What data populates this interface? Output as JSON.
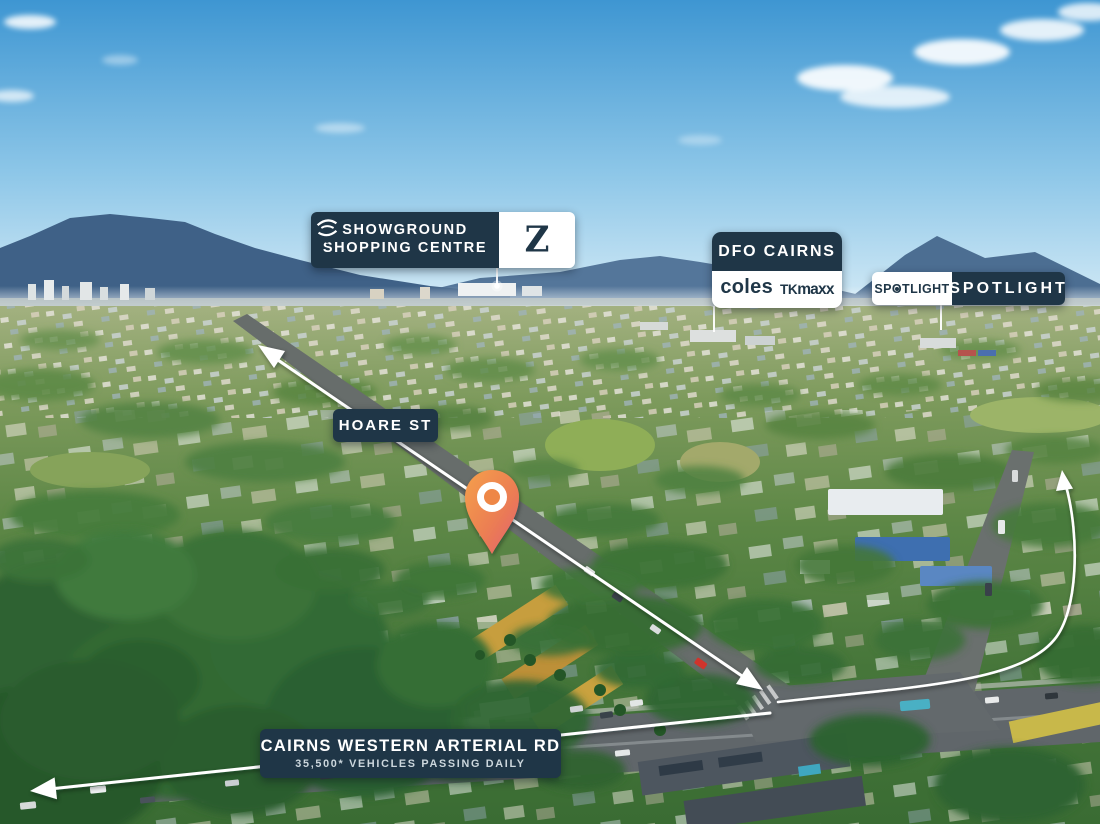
{
  "labels": {
    "showground": {
      "line1": "SHOWGROUND",
      "line2": "SHOPPING CENTRE",
      "logo_z": "Z"
    },
    "dfo": {
      "name": "DFO CAIRNS",
      "tenant_coles": "coles",
      "tenant_tk": "TK",
      "tenant_maxx": "maxx"
    },
    "spotlight": {
      "logo_pre": "SP",
      "logo_o": "O",
      "logo_post": "TLIGHT",
      "name": "SPOTLIGHT"
    },
    "street": {
      "name": "HOARE ST"
    },
    "arterial": {
      "name": "CAIRNS WESTERN ARTERIAL RD",
      "traffic": "35,500* VEHICLES PASSING DAILY"
    }
  },
  "icons": {
    "location_pin": "orange teardrop map pin with white ring",
    "oz_emblem": "circular swirl emblem",
    "z_logo": "textured letter Z",
    "spotlight_o": "letter O with centre dot",
    "arrows": "white route arrows on roads"
  },
  "colors": {
    "navy": "#1f3647",
    "white": "#ffffff",
    "pin_top": "#f5a04c",
    "pin_bottom": "#e25f70",
    "arrow": "#ffffff",
    "sky_top": "#3e96d2",
    "mountain": "#3f6187"
  }
}
